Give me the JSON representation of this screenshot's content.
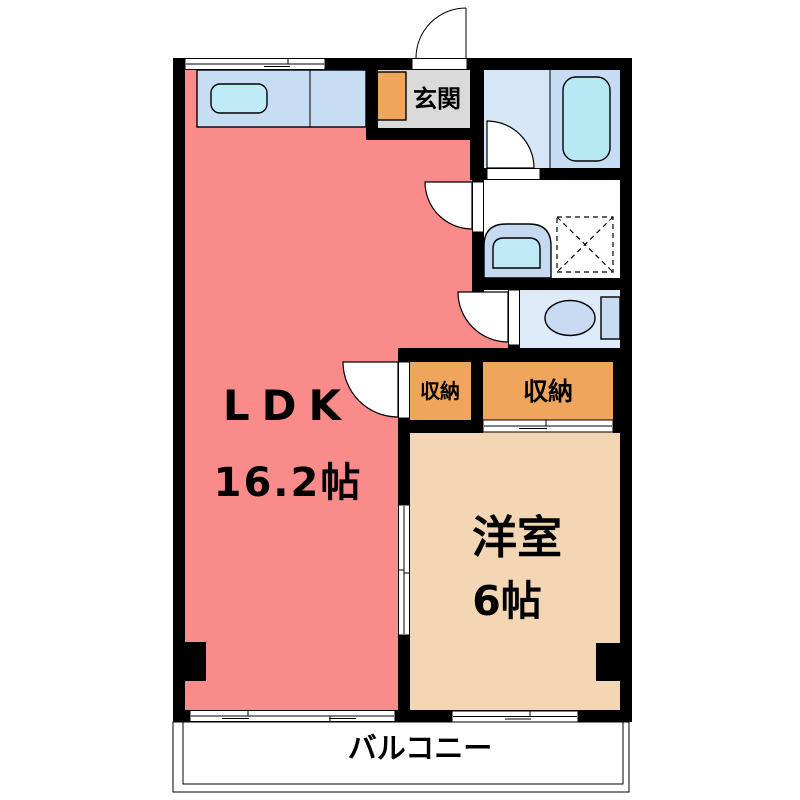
{
  "floorplan": {
    "rooms": {
      "ldk": {
        "name": "LDK",
        "area": "16.2帖"
      },
      "western_room": {
        "name": "洋室",
        "area": "6帖"
      },
      "entrance": {
        "name": "玄関"
      },
      "storage_small": {
        "name": "収納"
      },
      "storage_large": {
        "name": "収納"
      },
      "balcony": {
        "name": "バルコニー"
      }
    },
    "colors": {
      "wall": "#000000",
      "ldk": "#F98B8B",
      "western_room": "#F3D7B4",
      "storage": "#F0A55C",
      "cabinet": "#F0A55C",
      "entrance_floor": "#DADADA",
      "balcony_floor": "#DBD7D1",
      "bathroom": "#D6E7F8",
      "bathtub_area": "#C6DCF4",
      "bathtub": "#B6E9F4",
      "kitchen_counter": "#C6DDF4",
      "kitchen_sink": "#BEEBF5",
      "washroom": "#FFFFFF",
      "toilet_room": "#DDEAF8",
      "toilet_fixture": "#C9DBF2",
      "basin_outer": "#C5D9F1",
      "basin_inner": "#BEEBF5"
    }
  }
}
